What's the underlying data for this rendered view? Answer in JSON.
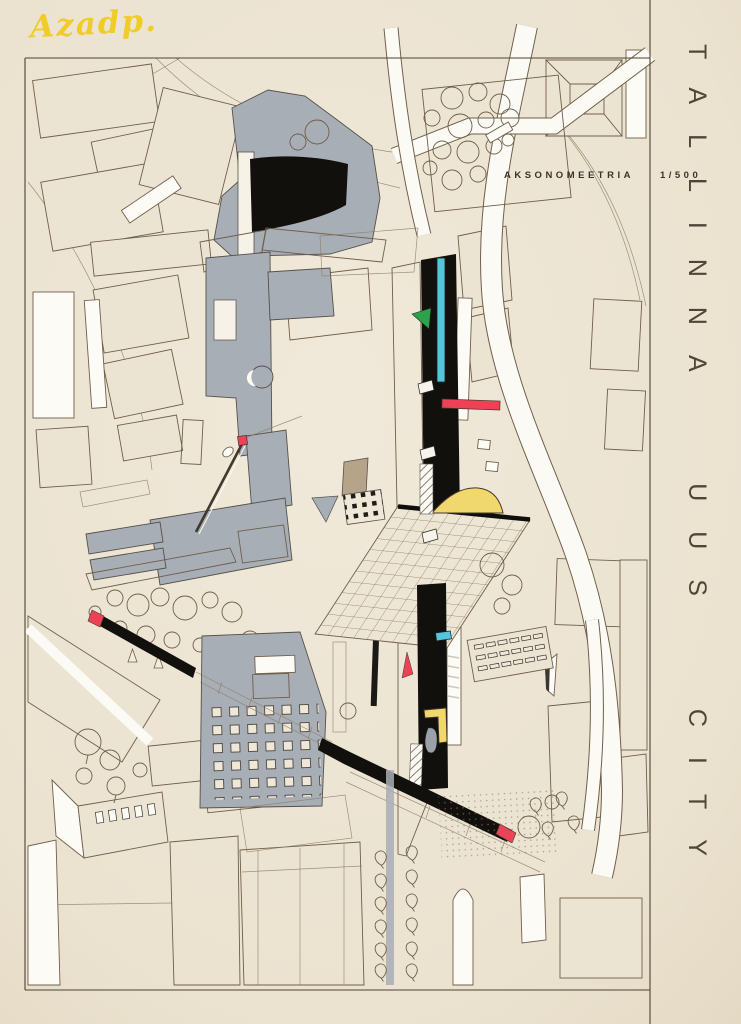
{
  "poster": {
    "signature": "Azadp.",
    "title_vertical": "TALLINNA UUS CITY"
  },
  "annotation": {
    "label": "AKSONOMEETRIA",
    "scale": "1/500"
  },
  "palette": {
    "paper": "#ece4d3",
    "ink_line": "#6f5f49",
    "building_gray": "#a8aeb6",
    "tower_black": "#12100d",
    "accent_cyan": "#54c5da",
    "accent_red": "#ed4156",
    "accent_yellow": "#f0d76e",
    "accent_green": "#2ea14d",
    "signature_yellow": "#f0cc29"
  }
}
